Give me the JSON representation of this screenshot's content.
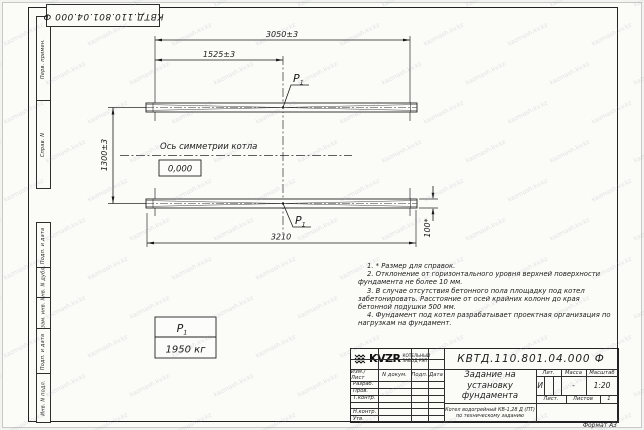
{
  "watermark": "kazmash.kv.kz",
  "stamp_top": {
    "designation": "КВТД.110.801.04.000 Ф"
  },
  "margin_labels": [
    "Перв. примен.",
    "Справ. N",
    "Подп. и дата",
    "Инв. N дубл.",
    "Взам. инв. N",
    "Подп. и дата",
    "Инв. N подл."
  ],
  "drawing": {
    "dim_3050": "3050±3",
    "dim_1525": "1525±3",
    "dim_1300": "1300±3",
    "dim_3210": "3210",
    "dim_100": "100*",
    "axis_label": "Ось симметрии котла",
    "level_mark": "0,000",
    "load_label": "P",
    "load_sub": "1",
    "load_value": "1950 кг"
  },
  "notes": [
    "1. * Размер для справок.",
    "2. Отклонение от горизонтального уровня верхней поверхности фундамента не более 10 мм.",
    "3. В случае отсутствия бетонного пола площадку под котел забетонировать. Расстояние от осей крайних колонн до края бетонной подушки 500 мм.",
    "4. Фундамент под котел разрабатывает проектная организация по нагрузкам на фундамент."
  ],
  "title_block": {
    "designation": "КВТД.110.801.04.000 Ф",
    "title_line1": "Задание на",
    "title_line2": "установку",
    "title_line3": "фундамента",
    "subtitle_line1": "Котел водогрейный КВ-1,28 Д (ПТ)",
    "subtitle_line2": "по техническому заданию",
    "header_cols": [
      "Изм./Лист",
      "N докум.",
      "Подп.",
      "Дата"
    ],
    "rows": [
      "Разраб.",
      "Пров.",
      "Т.контр.",
      "",
      "Н.контр.",
      "Утв."
    ],
    "lit_header": [
      "Лит.",
      "Масса",
      "Масштаб"
    ],
    "lit_value": "И",
    "mass_value": "-",
    "scale_value": "1:20",
    "sheet_label": "Лист.",
    "sheets_label": "Листов",
    "sheets_value": "1",
    "logo_text": "KVZR",
    "logo_caption_line1": "КОТЕЛЬНЫЙ",
    "logo_caption_line2": "ЗАВОД РЭП",
    "format_label": "Формат А3"
  }
}
